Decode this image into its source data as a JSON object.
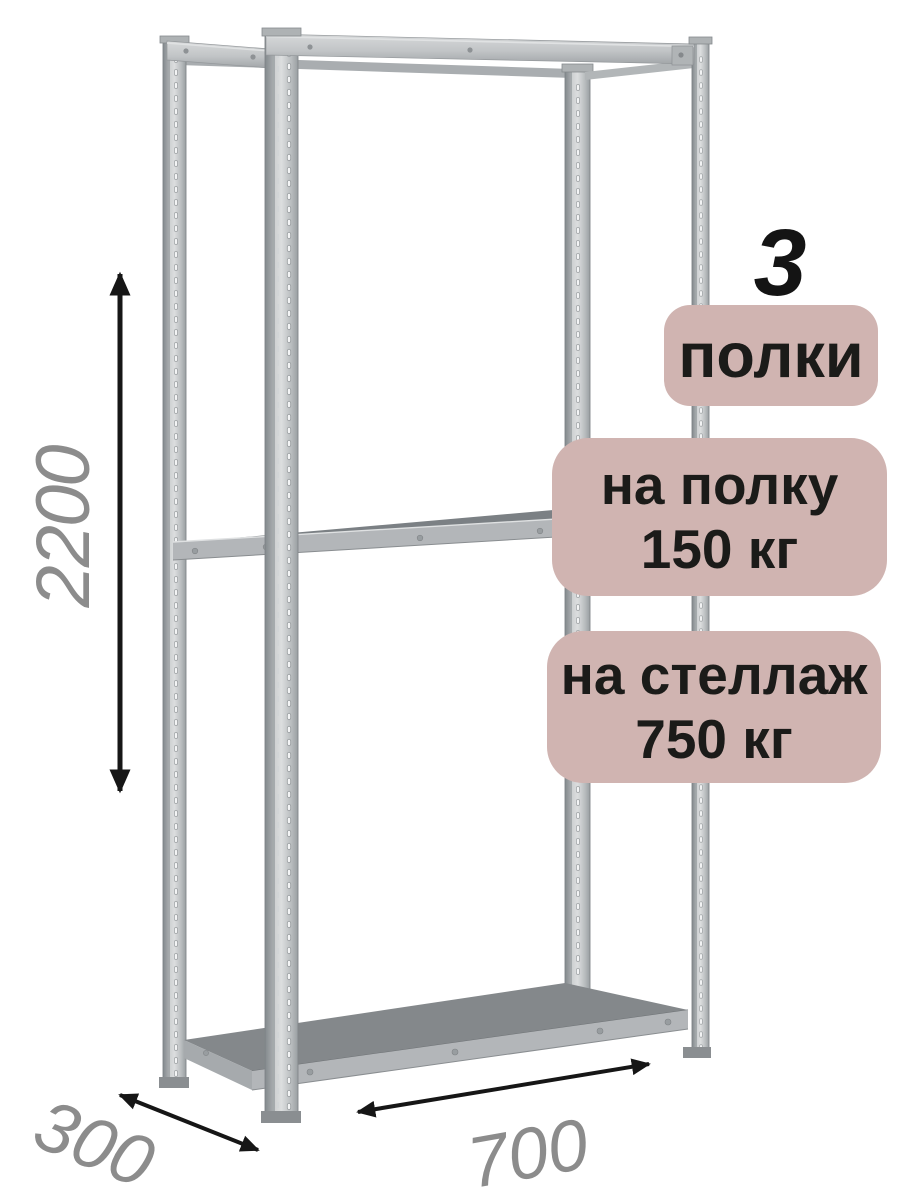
{
  "badges": {
    "count": {
      "number": "3",
      "label": "полки"
    },
    "per_shelf": {
      "line1": "на полку",
      "line2": "150 кг"
    },
    "per_rack": {
      "line1": "на стеллаж",
      "line2": "750 кг"
    }
  },
  "dimensions": {
    "height": {
      "value": "2200",
      "icon": "vertical-double-arrow"
    },
    "depth": {
      "value": "300",
      "icon": "diagonal-double-arrow"
    },
    "width": {
      "value": "700",
      "icon": "diagonal-double-arrow"
    }
  },
  "colors": {
    "background": "#ffffff",
    "badge_bg": "#d0b4b1",
    "badge_text": "#1b1b19",
    "dimension_text": "#8c8c8c",
    "arrow": "#161616",
    "metal_light": "#d6d9db",
    "metal_mid": "#b3b6b9",
    "metal_dark": "#8a8e91",
    "shelf_top": "#7e8286"
  }
}
